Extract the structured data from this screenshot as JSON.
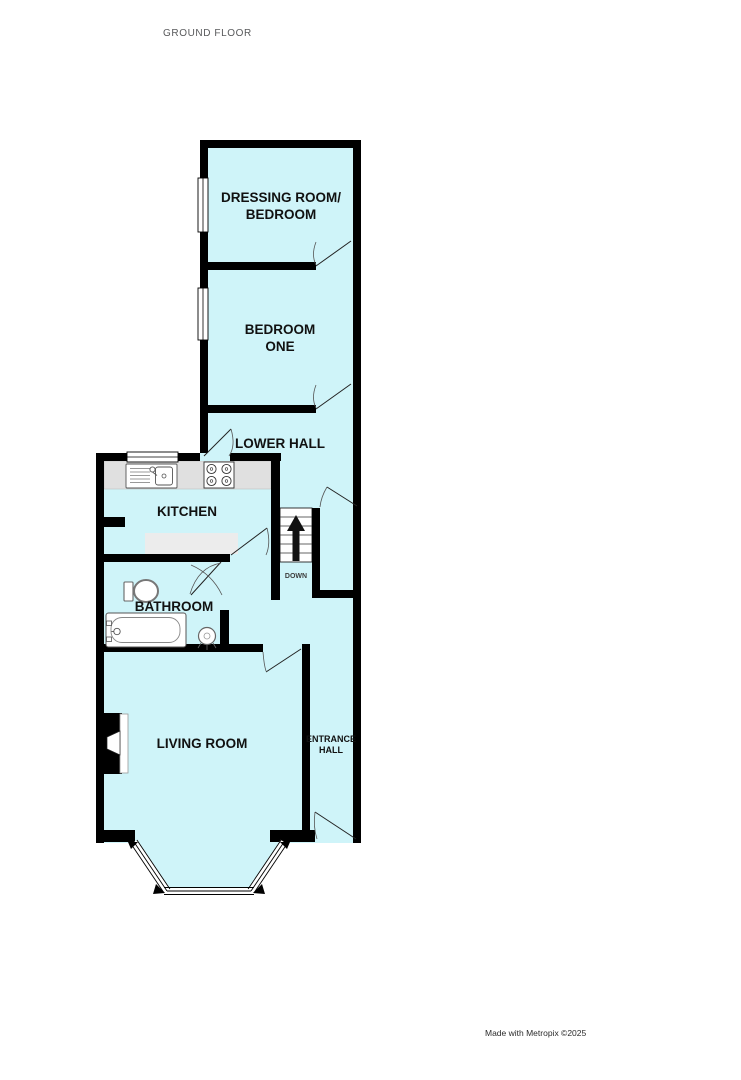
{
  "title": "GROUND FLOOR",
  "credit": "Made with Metropix ©2025",
  "colors": {
    "room_fill": "#cff4f9",
    "wall": "#000000",
    "counter": "#e0e0e0",
    "kitchen_unit": "#ececec",
    "title_text": "#58595b",
    "label_text": "#111111"
  },
  "rooms": {
    "dressing_room": {
      "line1": "DRESSING ROOM/",
      "line2": "BEDROOM"
    },
    "bedroom_one": {
      "line1": "BEDROOM",
      "line2": "ONE"
    },
    "lower_hall": {
      "label": "LOWER HALL"
    },
    "kitchen": {
      "label": "KITCHEN"
    },
    "bathroom": {
      "label": "BATHROOM"
    },
    "living_room": {
      "label": "LIVING ROOM"
    },
    "entrance_hall": {
      "line1": "ENTRANCE",
      "line2": "HALL"
    },
    "stairs": {
      "label": "DOWN"
    }
  },
  "fixtures": {
    "kitchen": [
      "sink",
      "hob",
      "worktop",
      "base-unit"
    ],
    "bathroom": [
      "toilet",
      "bathtub",
      "basin"
    ],
    "other": [
      "staircase",
      "bay-window",
      "chimney-breast",
      "windows",
      "doors"
    ]
  }
}
